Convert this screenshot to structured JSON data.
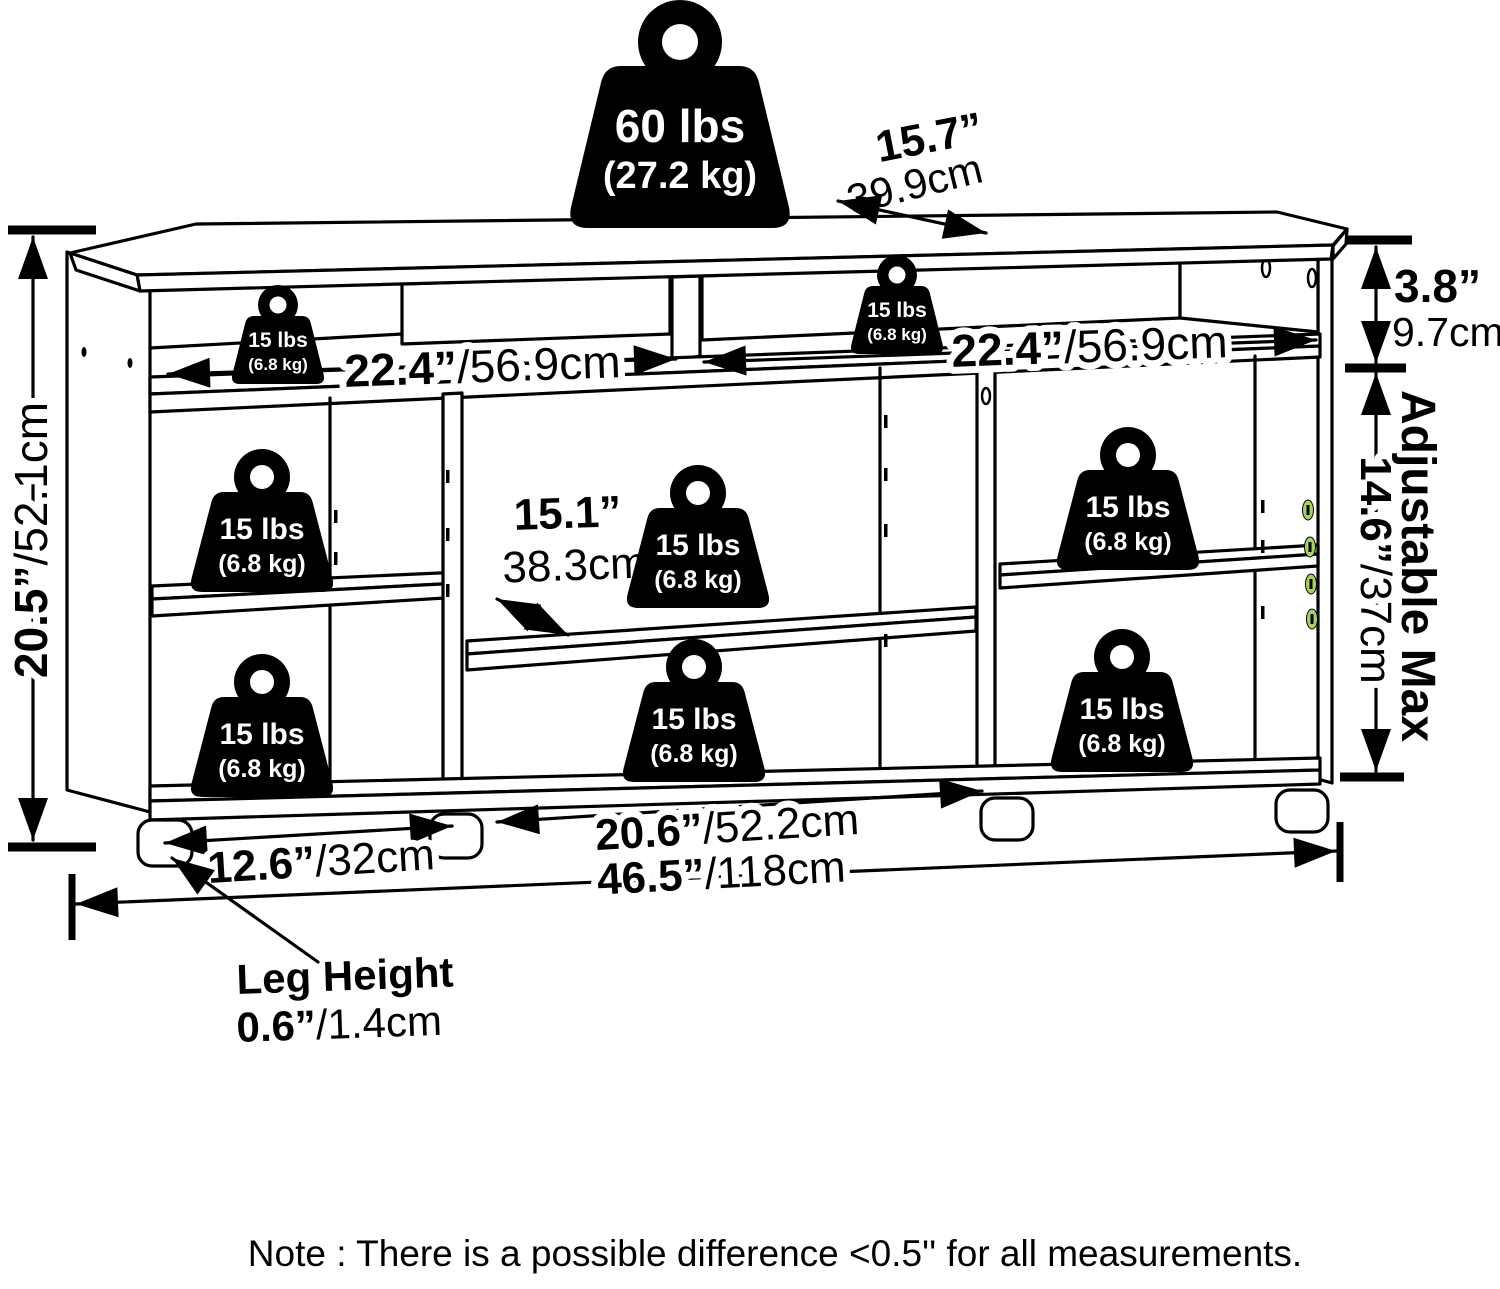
{
  "weights": {
    "top_weight": {
      "lbs": "60 lbs",
      "kg": "(27.2 kg)"
    },
    "shelf_weight": {
      "lbs": "15 lbs",
      "kg": "(6.8 kg)"
    }
  },
  "dimensions": {
    "depth": {
      "inches": "15.7”",
      "cm": "39.9cm"
    },
    "top_section_height": {
      "inches": "3.8”",
      "cm": "9.7cm"
    },
    "overall_height": {
      "inches": "20.5”",
      "cm": "/52.1cm"
    },
    "left_top_shelf_width": {
      "inches": "22.4”",
      "cm": "/56.9cm"
    },
    "right_top_shelf_width": {
      "inches": "22.4”",
      "cm": "/56.9cm"
    },
    "adjustable_height": {
      "inches": "14.6”",
      "cm": "/37cm"
    },
    "middle_shelf_depth": {
      "inches": "15.1”",
      "cm": "38.3cm"
    },
    "left_compartment_width": {
      "inches": "12.6”",
      "cm": "/32cm"
    },
    "middle_compartment_width": {
      "inches": "20.6”",
      "cm": "/52.2cm"
    },
    "overall_width": {
      "inches": "46.5”",
      "cm": "/118cm"
    },
    "leg_height": {
      "label": "Leg Height",
      "inches": "0.6”",
      "cm": "/1.4cm"
    }
  },
  "labels": {
    "adjustable_max": "Adjustable Max"
  },
  "note": "Note : There is a possible difference <0.5'' for all measurements.",
  "colors": {
    "accent_green": "#a6d35e",
    "line_black": "#000000",
    "background": "#ffffff"
  }
}
